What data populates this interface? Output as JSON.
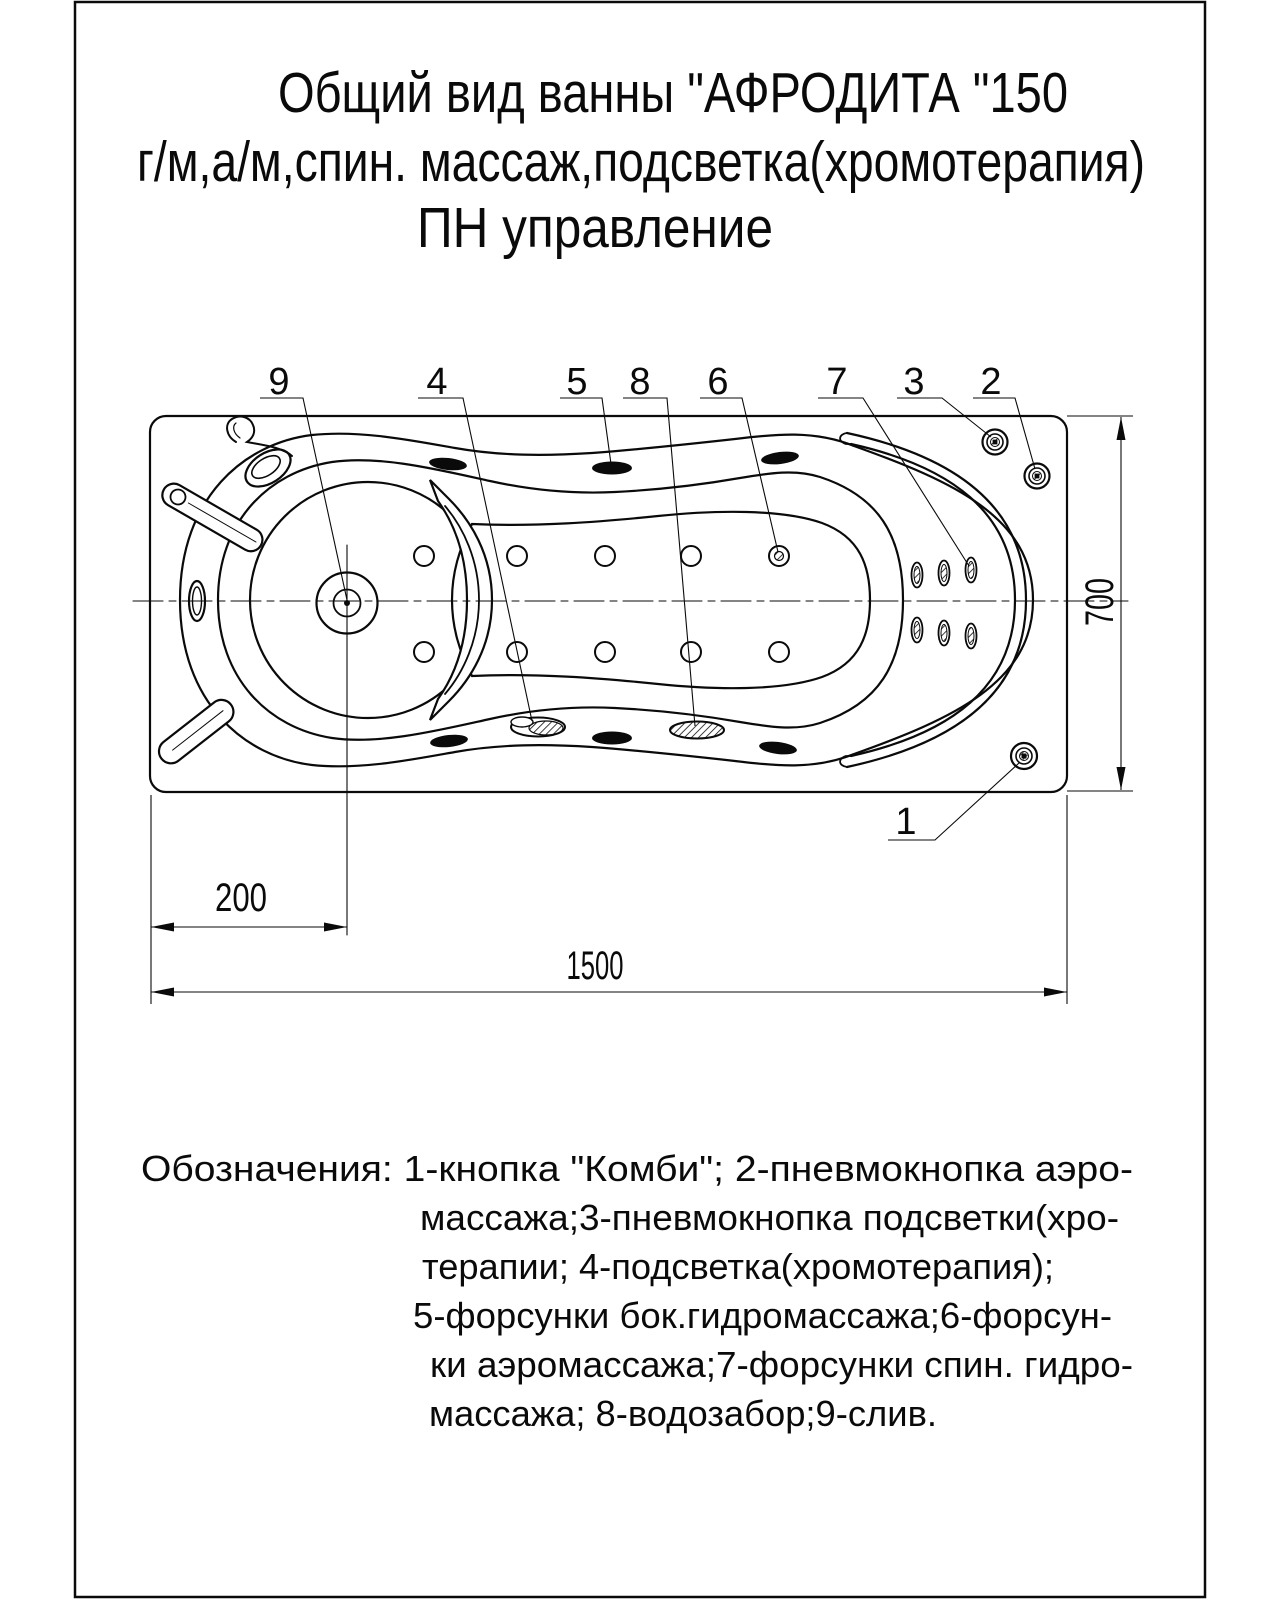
{
  "title": {
    "line1": "Общий вид ванны \"АФРОДИТА \"150",
    "line2": "г/м,а/м,спин. массаж,подсветка(хромотерапия)",
    "line3": "ПН управление"
  },
  "drawing": {
    "callouts": [
      {
        "label": "9",
        "meaning": "слив"
      },
      {
        "label": "4",
        "meaning": "подсветка(хромотерапия)"
      },
      {
        "label": "5",
        "meaning": "форсунки бок.гидромассажа"
      },
      {
        "label": "8",
        "meaning": "водозабор"
      },
      {
        "label": "6",
        "meaning": "форсунки аэромассажа"
      },
      {
        "label": "7",
        "meaning": "форсунки спин. гидромассажа"
      },
      {
        "label": "3",
        "meaning": "пневмокнопка подсветки(хромотерапии)"
      },
      {
        "label": "2",
        "meaning": "пневмокнопка аэромассажа"
      },
      {
        "label": "1",
        "meaning": "кнопка \"Комби\""
      }
    ],
    "dimensions": {
      "drain_offset": "200",
      "length": "1500",
      "width": "700"
    },
    "line_color": "#0a0a0a"
  },
  "legend": {
    "lines": [
      "Обозначения: 1-кнопка \"Комби\"; 2-пневмокнопка аэро-",
      "массажа;3-пневмокнопка подсветки(хро-",
      "терапии; 4-подсветка(хромотерапия);",
      "5-форсунки бок.гидромассажа;6-форсун-",
      "ки аэромассажа;7-форсунки спин. гидро-",
      "массажа; 8-водозабор;9-слив."
    ]
  }
}
